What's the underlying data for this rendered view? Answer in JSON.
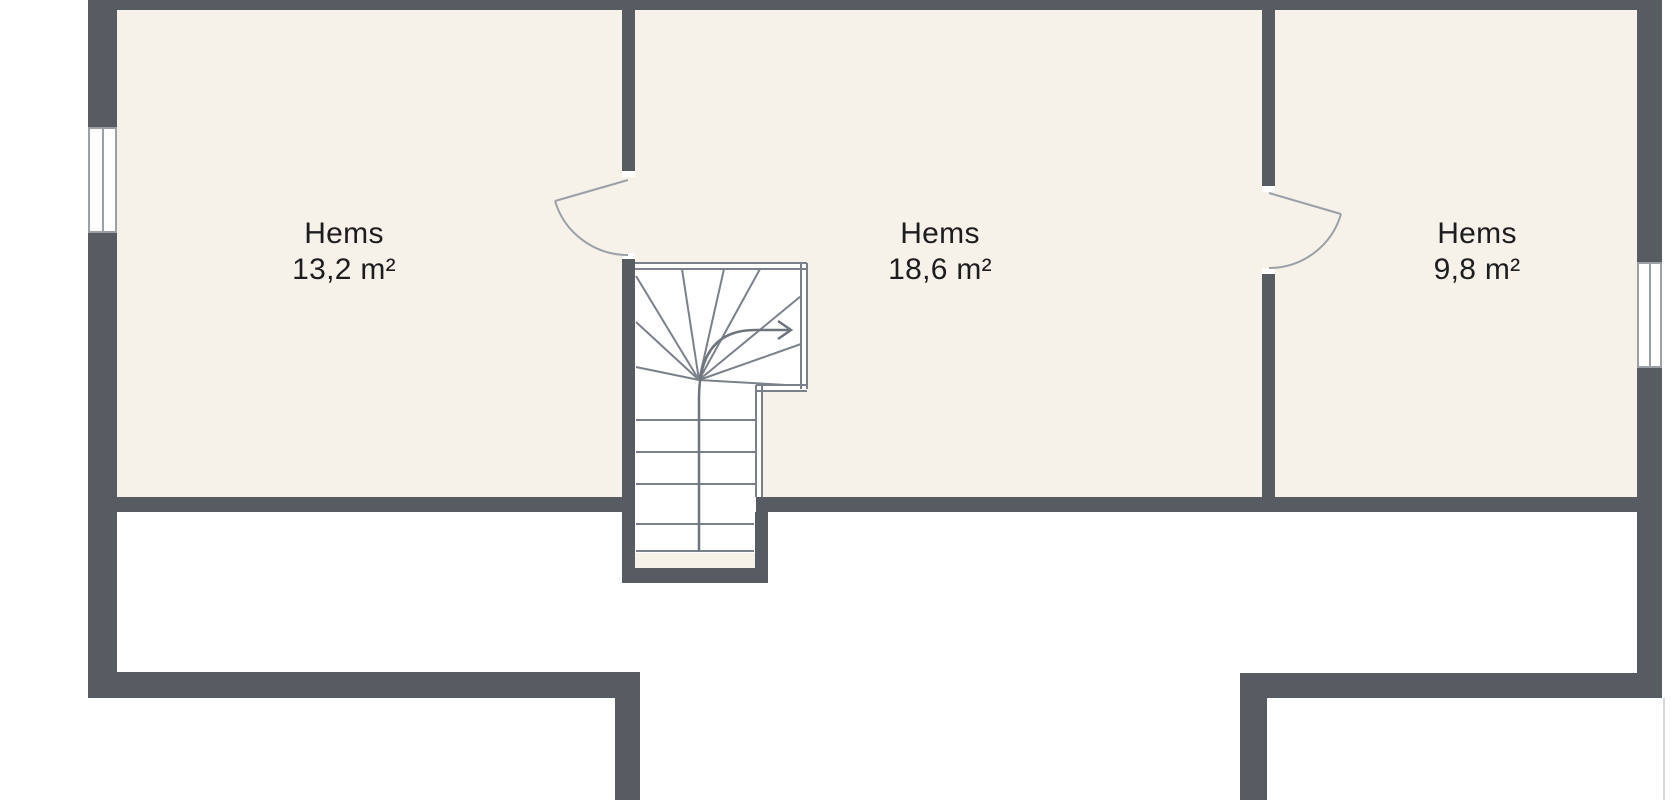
{
  "floor_plan": {
    "rooms": [
      {
        "name": "Hems",
        "area": "13,2 m²"
      },
      {
        "name": "Hems",
        "area": "18,6 m²"
      },
      {
        "name": "Hems",
        "area": "9,8 m²"
      }
    ],
    "colors": {
      "wall": "#575c63",
      "floor": "#f6f2e9",
      "line": "#9aa0a6",
      "line-dark": "#7b818a",
      "rail": "#6e747d",
      "text": "#1d1d1f",
      "edge": "#d5d7d9"
    }
  }
}
